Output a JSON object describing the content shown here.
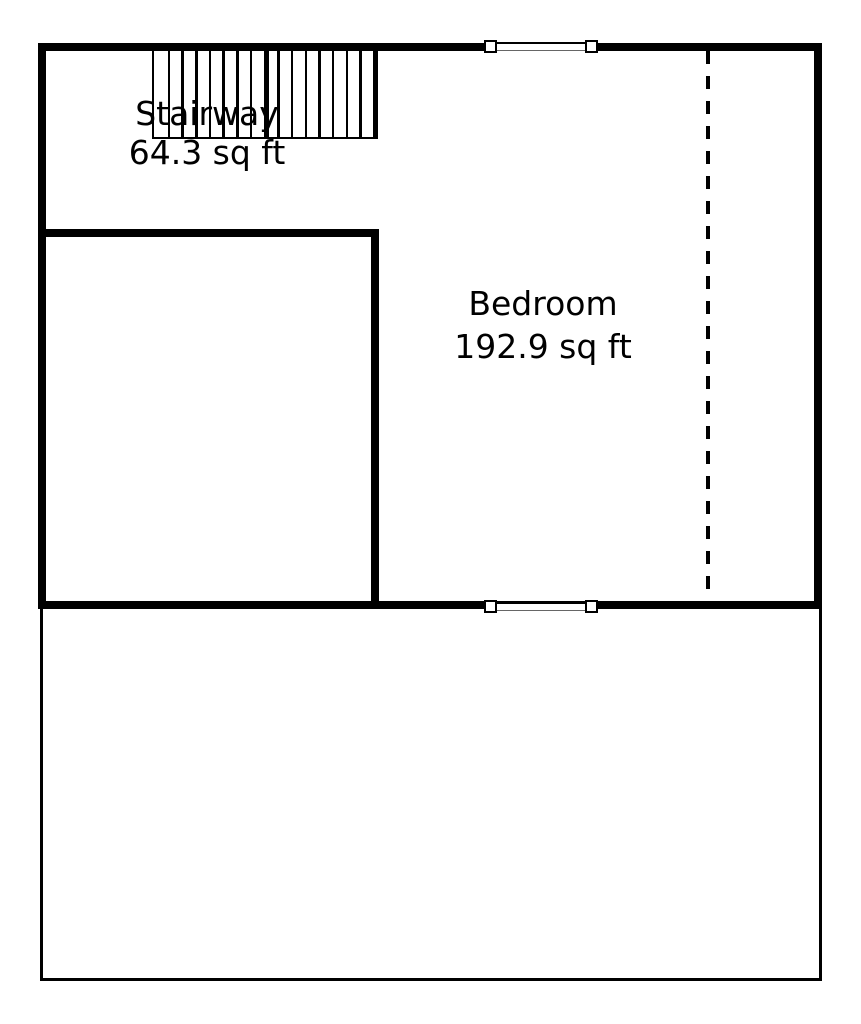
{
  "colors": {
    "wall": "#000000",
    "background": "#ffffff",
    "text": "#000000"
  },
  "rooms": [
    {
      "name": "Stairway",
      "area": "64.3 sq ft"
    },
    {
      "name": "Bedroom",
      "area": "192.9 sq ft"
    }
  ],
  "stairway": {
    "tread_count": 15,
    "thick_tread_index": 8
  },
  "windows": [
    {
      "icon": "window-icon",
      "location": "top-wall"
    },
    {
      "icon": "window-icon",
      "location": "middle-wall"
    }
  ],
  "dashed_line": {
    "icon": "dashed-projection-line"
  }
}
